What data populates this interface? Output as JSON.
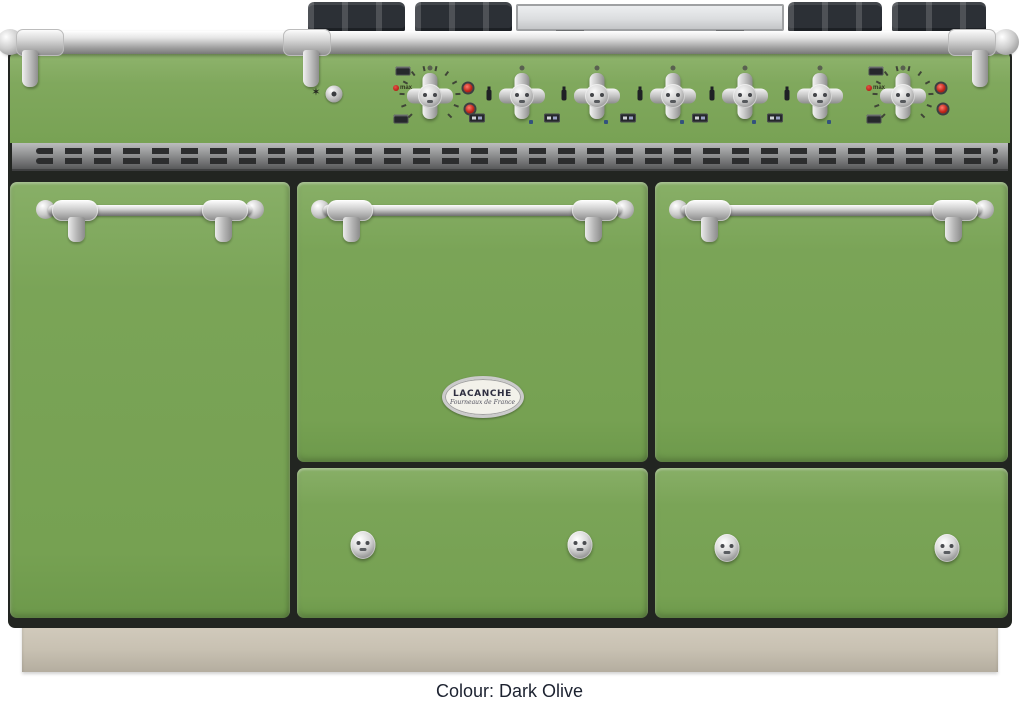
{
  "caption": "Colour: Dark Olive",
  "badge": {
    "title": "LACANCHE",
    "subtitle": "Fourneaux de France"
  },
  "control_panel": {
    "ignition_star_glyph": "✶",
    "oven_dial_label": "max",
    "knobs": [
      {
        "type": "oven",
        "x": 430
      },
      {
        "type": "burner",
        "x": 522
      },
      {
        "type": "burner",
        "x": 597
      },
      {
        "type": "burner",
        "x": 673
      },
      {
        "type": "burner",
        "x": 745
      },
      {
        "type": "burner",
        "x": 820
      },
      {
        "type": "oven",
        "x": 903
      }
    ]
  },
  "colors": {
    "body_green": "#7AA457",
    "panel_green": "#80A85D",
    "gap_dark": "#222521",
    "plinth_beige": "#C8C1B2",
    "chrome_light": "#F2F2F2",
    "chrome_dark": "#8C8C8C",
    "vent_gray": "#909192",
    "grate_black": "#2C3036",
    "plancha_gray": "#DCDEE0",
    "indicator_red": "#C1261B",
    "caption_text": "#1C2230",
    "badge_ivory": "#F2F1EA"
  }
}
